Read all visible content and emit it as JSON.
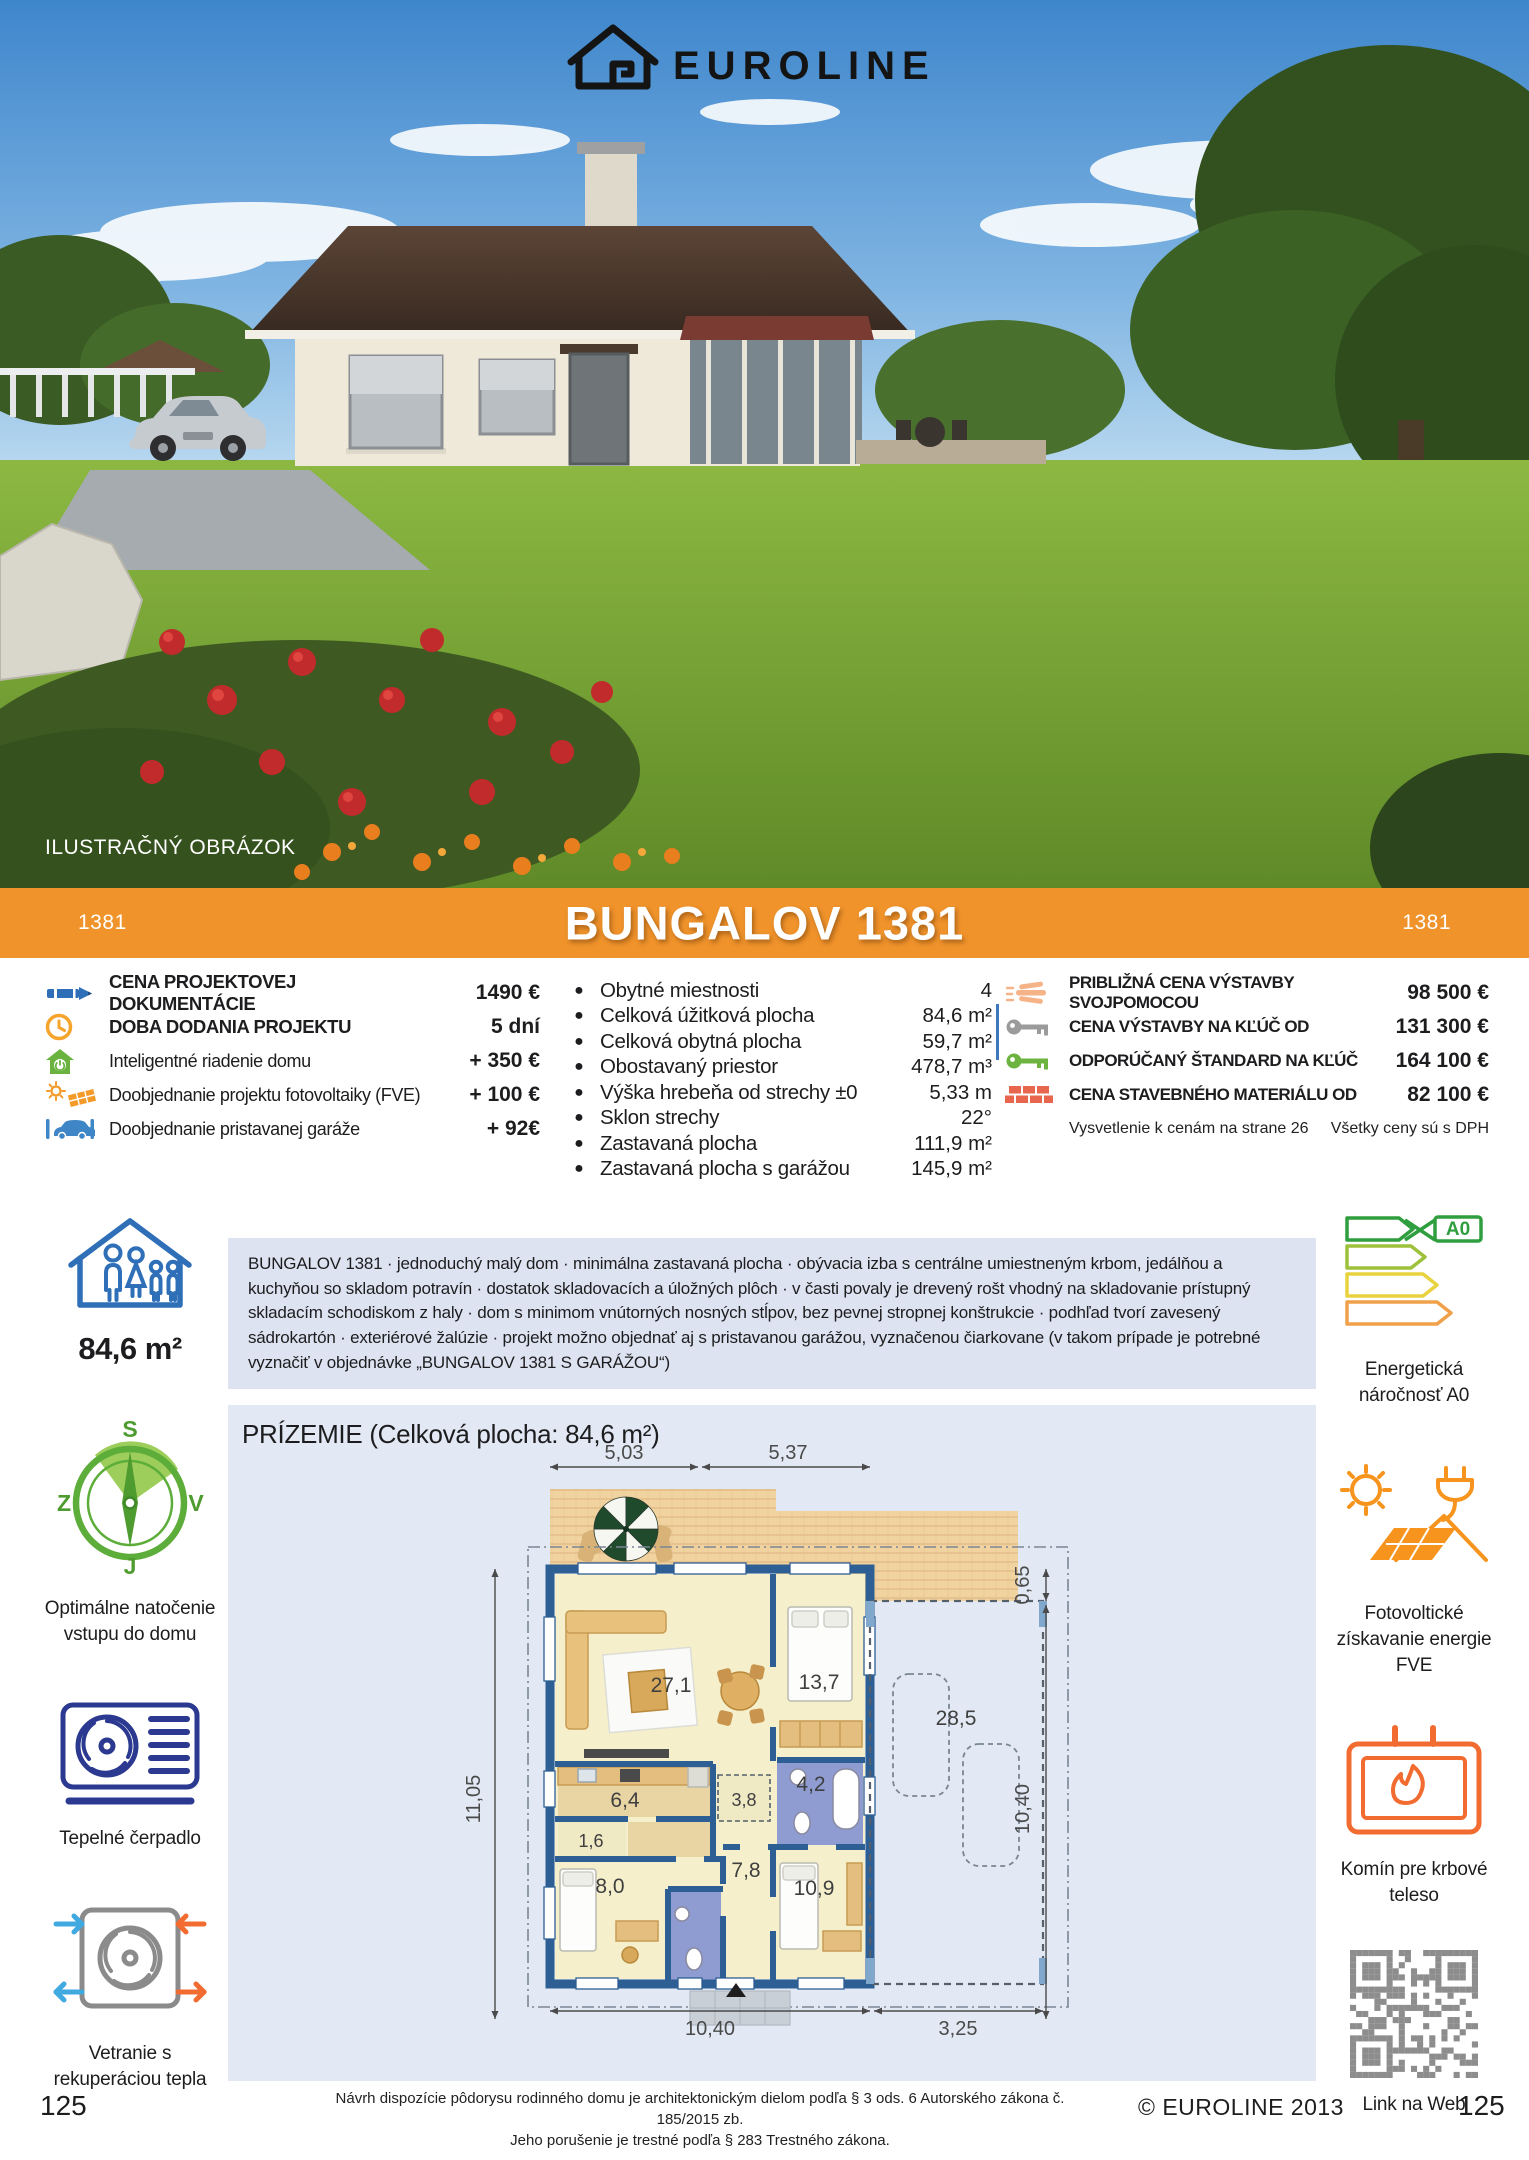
{
  "brand": {
    "name": "EUROLINE"
  },
  "photo": {
    "caption": "ILUSTRAČNÝ OBRÁZOK"
  },
  "banner": {
    "code_left": "1381",
    "title": "BUNGALOV 1381",
    "code_right": "1381",
    "color": "#F0932B"
  },
  "pricing_left": {
    "rows": [
      {
        "icon": "pencil-icon",
        "label": "CENA PROJEKTOVEJ DOKUMENTÁCIE",
        "value": "1490 €"
      },
      {
        "icon": "clock-icon",
        "label": "DOBA DODANIA PROJEKTU",
        "value": "5 dní"
      },
      {
        "icon": "smart-home-icon",
        "label": "Inteligentné riadenie domu",
        "value": "+ 350 €"
      },
      {
        "icon": "solar-project-icon",
        "label": "Doobjednanie projektu fotovoltaiky (FVE)",
        "value": "+ 100 €"
      },
      {
        "icon": "garage-car-icon",
        "label": "Doobjednanie pristavanej garáže",
        "value": "+ 92€"
      }
    ]
  },
  "specs": {
    "rows": [
      {
        "label": "Obytné miestnosti",
        "value": "4"
      },
      {
        "label": "Celková úžitková plocha",
        "value": "84,6 m²"
      },
      {
        "label": "Celková obytná plocha",
        "value": "59,7 m²"
      },
      {
        "label": "Obostavaný priestor",
        "value": "478,7 m³"
      },
      {
        "label": "Výška hrebeňa od strechy ±0",
        "value": "5,33 m"
      },
      {
        "label": "Sklon strechy",
        "value": "22°"
      },
      {
        "label": "Zastavaná plocha",
        "value": "111,9 m²"
      },
      {
        "label": "Zastavaná plocha s garážou",
        "value": "145,9 m²"
      }
    ]
  },
  "pricing_right": {
    "rows": [
      {
        "icon": "hand-icon",
        "label": "PRIBLIŽNÁ CENA VÝSTAVBY SVOJPOMOCOU",
        "value": "98 500 €"
      },
      {
        "icon": "key-gray-icon",
        "label": "CENA VÝSTAVBY NA KĽÚČ OD",
        "value": "131 300 €"
      },
      {
        "icon": "key-green-icon",
        "label": "ODPORÚČANÝ ŠTANDARD NA KĽÚČ",
        "value": "164 100 €"
      },
      {
        "icon": "bricks-icon",
        "label": "CENA STAVEBNÉHO MATERIÁLU OD",
        "value": "82 100 €"
      }
    ],
    "note_left": "Vysvetlenie k cenám na strane 26",
    "note_right": "Všetky ceny sú s DPH"
  },
  "description": {
    "text": "BUNGALOV 1381 · jednoduchý malý dom · minimálna zastavaná plocha · obývacia izba s centrálne umiestneným krbom, jedálňou a kuchyňou so skladom potravín · dostatok skladovacích a úložných plôch · v časti povaly je drevený rošt vhodný na skladovanie prístupný skladacím schodiskom z haly · dom s minimom vnútorných nosných stĺpov, bez pevnej stropnej konštrukcie · podhľad tvorí zavesený sádrokartón · exteriérové žalúzie ·  projekt možno objednať aj s pristavanou garážou, vyznačenou čiarkovane (v takom prípade je potrebné vyznačiť v objednávke „BUNGALOV 1381 S GARÁŽOU“)"
  },
  "sidebar_left": {
    "area": "84,6 m²",
    "compass": {
      "n": "S",
      "w": "Z",
      "e": "V",
      "s": "J"
    },
    "compass_caption": "Optimálne natočenie vstupu do domu",
    "heatpump_caption": "Tepelné čerpadlo",
    "ventilation_caption": "Vetranie s rekuperáciou tepla"
  },
  "sidebar_right": {
    "energy_badge": "A0",
    "energy_caption": "Energetická náročnosť A0",
    "pv_caption": "Fotovoltické získavanie energie FVE",
    "chimney_caption": "Komín pre krbové teleso",
    "qr_caption": "Link na Web"
  },
  "floorplan": {
    "title": "PRÍZEMIE (Celková plocha: 84,6 m²)",
    "dims": {
      "top_left": "5,03",
      "top_right": "5,37",
      "right_top": "0,65",
      "right_bottom": "10,40",
      "left": "11,05",
      "bottom_left": "10,40",
      "bottom_right": "3,25"
    },
    "rooms": {
      "living": "27,1",
      "bedroom1": "13,7",
      "kitchen": "6,4",
      "pantry": "1,6",
      "room2": "8,0",
      "storage": "3,8",
      "bath": "4,2",
      "hall": "7,8",
      "room3": "10,9",
      "garage": "28,5"
    }
  },
  "footer": {
    "legal1": "Návrh dispozície pôdorysu rodinného domu je architektonickým dielom podľa § 3 ods. 6 Autorského zákona č. 185/2015 zb.",
    "legal2": "Jeho porušenie je trestné podľa § 283 Trestného zákona.",
    "copyright": "© EUROLINE 2013",
    "page_left": "125",
    "page_right": "125"
  }
}
